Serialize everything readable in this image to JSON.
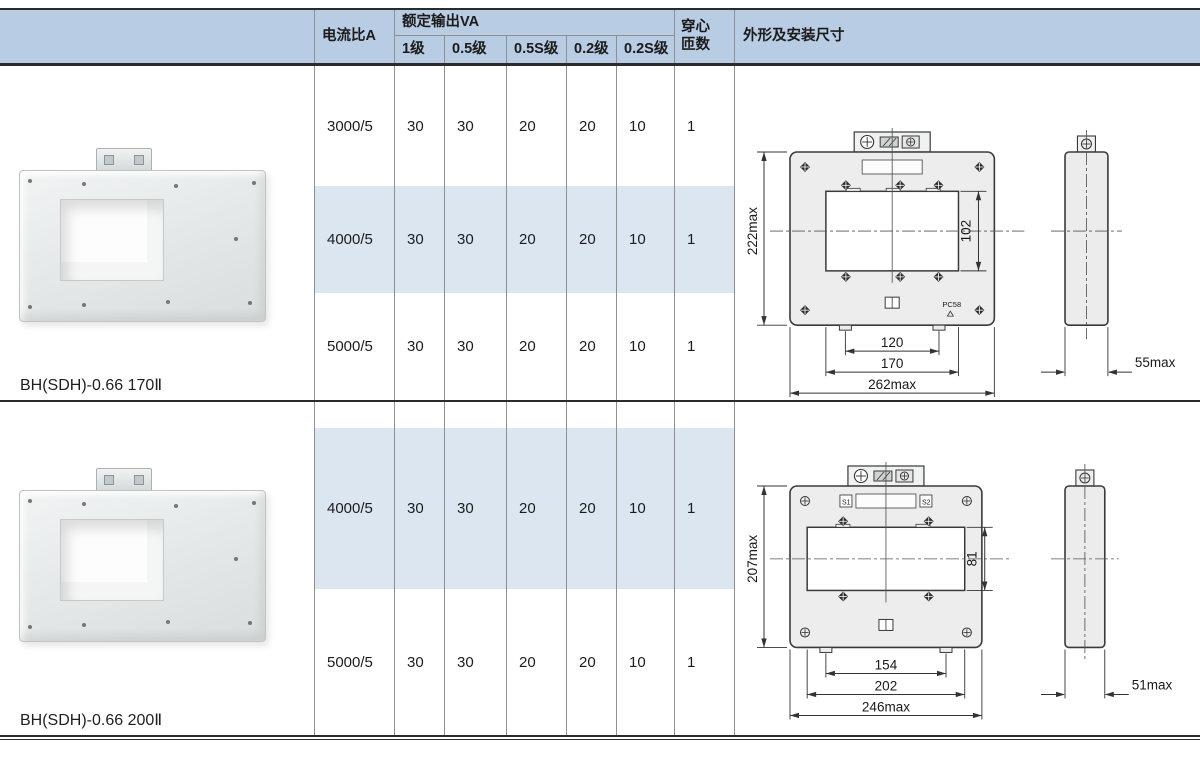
{
  "colors": {
    "header_bg": "#b8cce4",
    "row_highlight": "#dce6f1",
    "grid_line": "#8f8f8f",
    "rule_dark": "#2b2b2b",
    "text": "#1a1a1a"
  },
  "table": {
    "header": {
      "current_ratio": "电流比A",
      "rated_output": "额定输出VA",
      "classes": [
        "1级",
        "0.5级",
        "0.5S级",
        "0.2级",
        "0.2S级"
      ],
      "turns_lines": [
        "穿心",
        "匝数"
      ],
      "dimensions": "外形及安装尺寸"
    },
    "sections": [
      {
        "model": "BH(SDH)-0.66 170Ⅱ",
        "rows": [
          {
            "ratio": "3000/5",
            "values": [
              "30",
              "30",
              "20",
              "20",
              "10"
            ],
            "turns": "1",
            "highlight": false
          },
          {
            "ratio": "4000/5",
            "values": [
              "30",
              "30",
              "20",
              "20",
              "10"
            ],
            "turns": "1",
            "highlight": true
          },
          {
            "ratio": "5000/5",
            "values": [
              "30",
              "30",
              "20",
              "20",
              "10"
            ],
            "turns": "1",
            "highlight": false
          }
        ],
        "drawing": {
          "labels": {
            "overall_height": "222max",
            "window_height": "102",
            "hole_spacing": "120",
            "window_width": "170",
            "overall_width": "262max",
            "depth": "55max"
          },
          "mm": {
            "overall_height": 222,
            "window_height": 102,
            "hole_spacing": 120,
            "window_width": 170,
            "overall_width": 262,
            "depth": 55
          },
          "mark": "PC58",
          "plate_marks": [],
          "corner_screw": "diamond",
          "window_screws": 3,
          "notches": 3
        }
      },
      {
        "model": "BH(SDH)-0.66 200Ⅱ",
        "rows": [
          {
            "ratio": "4000/5",
            "values": [
              "30",
              "30",
              "20",
              "20",
              "10"
            ],
            "turns": "1",
            "highlight": true
          },
          {
            "ratio": "5000/5",
            "values": [
              "30",
              "30",
              "20",
              "20",
              "10"
            ],
            "turns": "1",
            "highlight": false
          }
        ],
        "drawing": {
          "labels": {
            "overall_height": "207max",
            "window_height": "81",
            "hole_spacing": "154",
            "window_width": "202",
            "overall_width": "246max",
            "depth": "51max"
          },
          "mm": {
            "overall_height": 207,
            "window_height": 81,
            "hole_spacing": 154,
            "window_width": 202,
            "overall_width": 246,
            "depth": 51
          },
          "mark": "",
          "plate_marks": [
            "S1",
            "S2"
          ],
          "corner_screw": "circle",
          "window_screws": 2,
          "notches": 2
        }
      }
    ]
  }
}
